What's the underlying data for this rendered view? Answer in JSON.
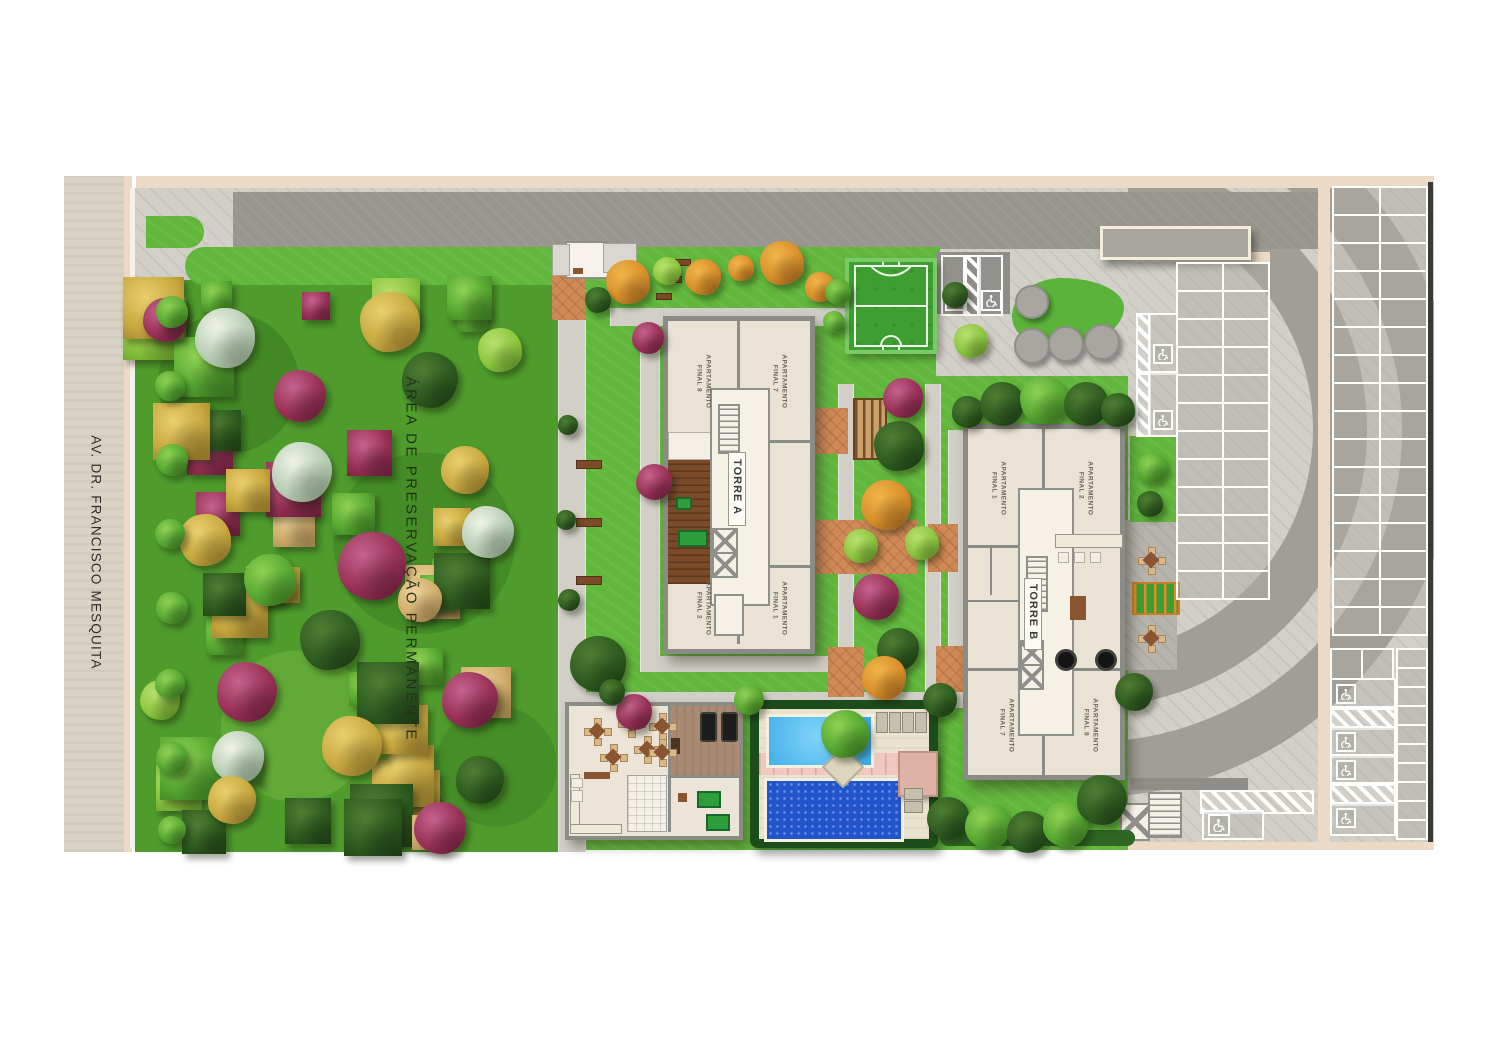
{
  "plan": {
    "street": {
      "label": "AV. DR. FRANCISCO MESQUITA"
    },
    "preservation": {
      "label": "ÁREA DE PRESERVAÇÃO PERMANENTE"
    },
    "towers": {
      "a": {
        "name": "TORRE A",
        "units": {
          "top_left": "APARTAMENTO FINAL 8",
          "top_right": "APARTAMENTO FINAL 7",
          "bottom_left": "APARTAMENTO FINAL 2",
          "bottom_right": "APARTAMENTO FINAL 1"
        }
      },
      "b": {
        "name": "TORRE B",
        "units": {
          "top_left": "APARTAMENTO FINAL 1",
          "top_right": "APARTAMENTO FINAL 2",
          "bottom_left": "APARTAMENTO FINAL 7",
          "bottom_right": "APARTAMENTO FINAL 8"
        }
      }
    },
    "icons": {
      "accessible_parking": "wheelchair-icon"
    },
    "colors": {
      "lawn": "#61b73b",
      "forest": "#4f9c2d",
      "street": "#d9d3c5",
      "wall": "#ecd9c6",
      "drive_dark": "#99968f",
      "paving_light": "#d3d0ca",
      "building": "#eae2d4",
      "building_wall": "#8b8b87",
      "terracotta": "#cf8a58",
      "pool_main": "#2254cb",
      "pool_kids": "#45b5ee",
      "pool_deck": "#e9e3cf",
      "hedge": "#1d4c1b",
      "court_green": "#3f9e31",
      "tree_magenta": "#993057",
      "tree_yellow": "#c9a93f",
      "pink_paving": "#efc9c0"
    }
  }
}
